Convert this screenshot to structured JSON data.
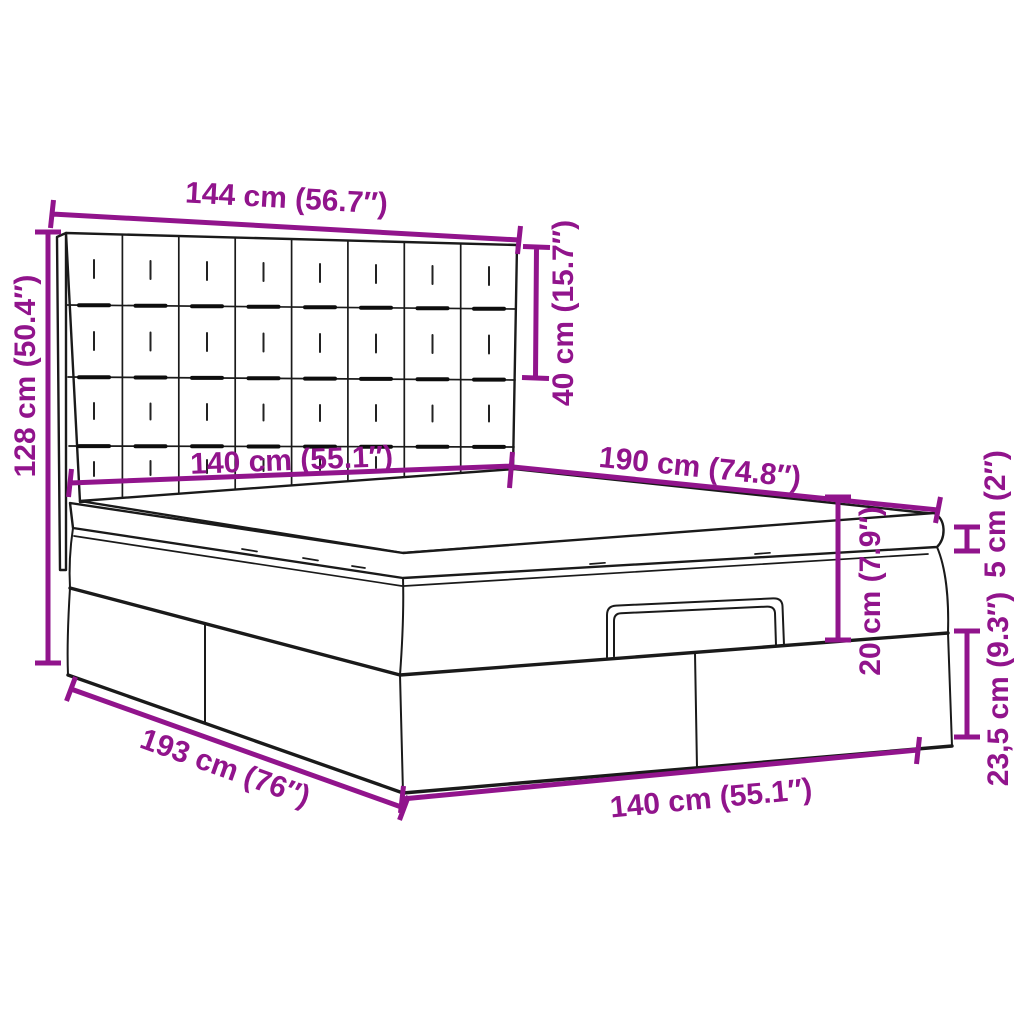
{
  "diagram": {
    "type": "product-dimension-diagram",
    "product": "ottoman-storage-bed-with-tufted-headboard",
    "accent_color": "#91148C",
    "line_color": "#1a1a1a",
    "background_color": "#ffffff"
  },
  "dimensions": {
    "headboard_width": "144 cm (56.7″)",
    "headboard_panel_height": "40 cm (15.7″)",
    "headboard_total_height": "128 cm (50.4″)",
    "mattress_width": "140 cm (55.1″)",
    "mattress_length": "190 cm (74.8″)",
    "topper_height": "5 cm (2″)",
    "frame_height": "20 cm (7.9″)",
    "base_height": "23,5 cm (9.3″)",
    "base_length": "193 cm (76″)",
    "base_width": "140 cm (55.1″)"
  }
}
